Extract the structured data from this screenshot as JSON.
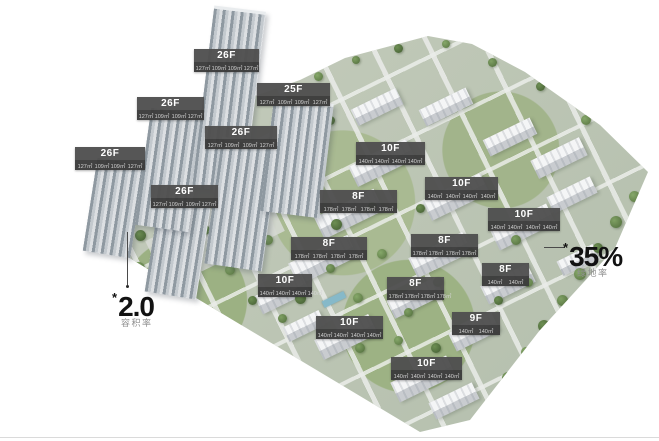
{
  "badges": [
    {
      "floors": "26F",
      "areas": [
        "127㎡",
        "109㎡",
        "109㎡",
        "127㎡"
      ]
    },
    {
      "floors": "26F",
      "areas": [
        "127㎡",
        "109㎡",
        "109㎡",
        "127㎡"
      ]
    },
    {
      "floors": "26F",
      "areas": [
        "127㎡",
        "109㎡",
        "109㎡",
        "127㎡"
      ]
    },
    {
      "floors": "26F",
      "areas": [
        "127㎡",
        "109㎡",
        "109㎡",
        "127㎡"
      ]
    },
    {
      "floors": "26F",
      "areas": [
        "127㎡",
        "109㎡",
        "109㎡",
        "127㎡"
      ]
    },
    {
      "floors": "25F",
      "areas": [
        "127㎡",
        "109㎡",
        "109㎡",
        "127㎡"
      ]
    },
    {
      "floors": "10F",
      "areas": [
        "140㎡",
        "140㎡",
        "140㎡",
        "140㎡"
      ]
    },
    {
      "floors": "10F",
      "areas": [
        "140㎡",
        "140㎡",
        "140㎡",
        "140㎡"
      ]
    },
    {
      "floors": "8F",
      "areas": [
        "178㎡",
        "178㎡",
        "178㎡",
        "178㎡"
      ]
    },
    {
      "floors": "8F",
      "areas": [
        "178㎡",
        "178㎡",
        "178㎡",
        "178㎡"
      ]
    },
    {
      "floors": "8F",
      "areas": [
        "178㎡",
        "178㎡",
        "178㎡",
        "178㎡"
      ]
    },
    {
      "floors": "10F",
      "areas": [
        "140㎡",
        "140㎡",
        "140㎡",
        "140㎡"
      ]
    },
    {
      "floors": "8F",
      "areas": [
        "140㎡",
        "140㎡"
      ]
    },
    {
      "floors": "8F",
      "areas": [
        "178㎡",
        "178㎡",
        "178㎡",
        "178㎡"
      ]
    },
    {
      "floors": "10F",
      "areas": [
        "140㎡",
        "140㎡",
        "140㎡",
        "140㎡"
      ]
    },
    {
      "floors": "10F",
      "areas": [
        "140㎡",
        "140㎡",
        "140㎡",
        "140㎡"
      ]
    },
    {
      "floors": "9F",
      "areas": [
        "140㎡",
        "140㎡"
      ]
    },
    {
      "floors": "10F",
      "areas": [
        "140㎡",
        "140㎡",
        "140㎡",
        "140㎡"
      ]
    }
  ],
  "annotations": {
    "plot_ratio": {
      "prefix": "*",
      "value": "2.0",
      "label": "容积率"
    },
    "greening_rate": {
      "prefix": "*",
      "value": "35%",
      "label": "绿地率"
    }
  },
  "colors": {
    "badge_title_bg": "#4f4f4f",
    "badge_area_bg": "#3a3a3a",
    "badge_title_text": "#ffffff",
    "badge_area_text": "#d4d4d4",
    "annotation_text": "#121212",
    "annotation_label": "#8f8f8f",
    "tree_green": "#66854c",
    "building_gray": "#e8eaec"
  }
}
